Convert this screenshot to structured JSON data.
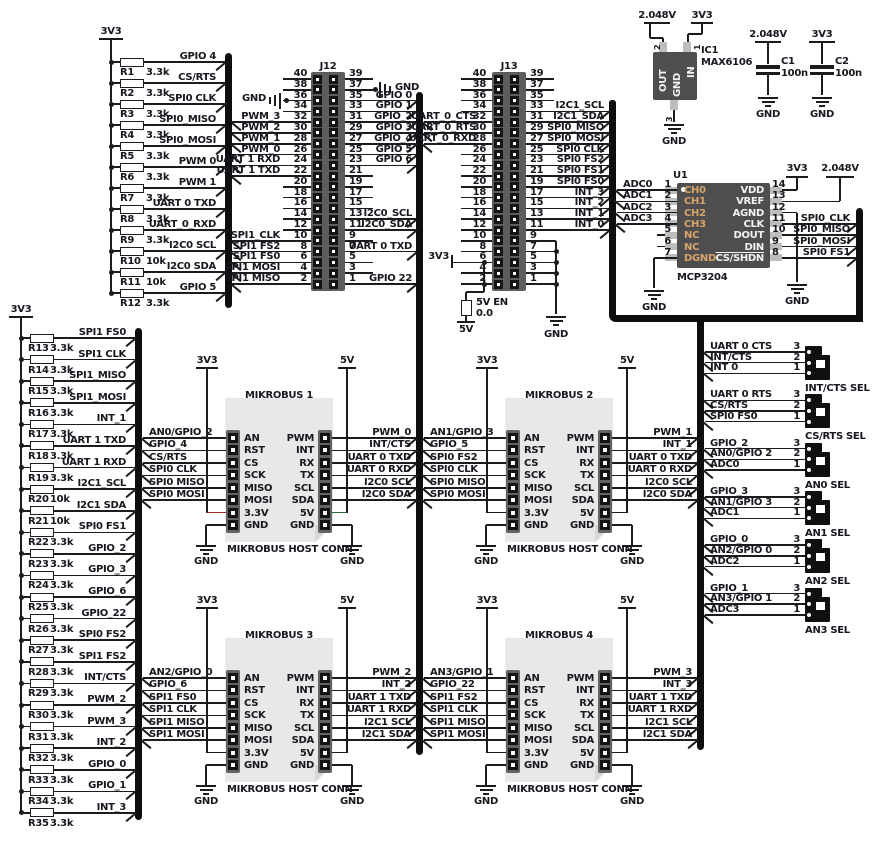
{
  "colors": {
    "wire": "#1c1c1e",
    "bus": "#0e0e10",
    "text": "#17171f",
    "chip_body": "#4e4e4e",
    "header_body": "#5d5d5d",
    "strip_body": "#636363",
    "pad": "#bdbdbd",
    "pin_dark": "#141414",
    "tan": "#d6a36a",
    "white": "#f2f2f2",
    "red": "#9b2f28",
    "green": "#2f6b33",
    "block_bg": "#e8e8e8",
    "fold": "#d8d8d8",
    "selector_body": "#101010"
  },
  "banks": {
    "top": {
      "rail": "3V3",
      "rows": [
        {
          "ref": "R1",
          "val": "3.3k",
          "sig": "GPIO 4"
        },
        {
          "ref": "R2",
          "val": "3.3k",
          "sig": "CS/RTS"
        },
        {
          "ref": "R3",
          "val": "3.3k",
          "sig": "SPI0 CLK"
        },
        {
          "ref": "R4",
          "val": "3.3k",
          "sig": "SPI0_MISO"
        },
        {
          "ref": "R5",
          "val": "3.3k",
          "sig": "SPI0_MOSI"
        },
        {
          "ref": "R6",
          "val": "3.3k",
          "sig": "PWM 0"
        },
        {
          "ref": "R7",
          "val": "3.3k",
          "sig": "PWM 1"
        },
        {
          "ref": "R8",
          "val": "3.3k",
          "sig": "UART 0 TXD"
        },
        {
          "ref": "R9",
          "val": "3.3k",
          "sig": "UART_0_RXD"
        },
        {
          "ref": "R10",
          "val": "10k",
          "sig": "I2C0 SCL"
        },
        {
          "ref": "R11",
          "val": "10k",
          "sig": "I2C0 SDA"
        },
        {
          "ref": "R12",
          "val": "3.3k",
          "sig": "GPIO 5"
        }
      ]
    },
    "left": {
      "rail": "3V3",
      "rows": [
        {
          "ref": "R13",
          "val": "3.3k",
          "sig": "SPI1 FS0"
        },
        {
          "ref": "R14",
          "val": "3.3k",
          "sig": "SPI1 CLK"
        },
        {
          "ref": "R15",
          "val": "3.3k",
          "sig": "SPI1_MISO"
        },
        {
          "ref": "R16",
          "val": "3.3k",
          "sig": "SPI1_MOSI"
        },
        {
          "ref": "R17",
          "val": "3.3k",
          "sig": "INT_1"
        },
        {
          "ref": "R18",
          "val": "3.3k",
          "sig": "UART 1 TXD"
        },
        {
          "ref": "R19",
          "val": "3.3k",
          "sig": "UART 1 RXD"
        },
        {
          "ref": "R20",
          "val": "10k",
          "sig": "I2C1_SCL"
        },
        {
          "ref": "R21",
          "val": "10k",
          "sig": "I2C1 SDA"
        },
        {
          "ref": "R22",
          "val": "3.3k",
          "sig": "SPI0 FS1"
        },
        {
          "ref": "R23",
          "val": "3.3k",
          "sig": "GPIO_2"
        },
        {
          "ref": "R24",
          "val": "3.3k",
          "sig": "GPIO_3"
        },
        {
          "ref": "R25",
          "val": "3.3k",
          "sig": "GPIO_6"
        },
        {
          "ref": "R26",
          "val": "3.3k",
          "sig": "GPIO_22"
        },
        {
          "ref": "R27",
          "val": "3.3k",
          "sig": "SPI0 FS2"
        },
        {
          "ref": "R28",
          "val": "3.3k",
          "sig": "SPI1 FS2"
        },
        {
          "ref": "R29",
          "val": "3.3k",
          "sig": "INT/CTS"
        },
        {
          "ref": "R30",
          "val": "3.3k",
          "sig": "PWM_2"
        },
        {
          "ref": "R31",
          "val": "3.3k",
          "sig": "PWM_3"
        },
        {
          "ref": "R32",
          "val": "3.3k",
          "sig": "INT_2"
        },
        {
          "ref": "R33",
          "val": "3.3k",
          "sig": "GPIO_0"
        },
        {
          "ref": "R34",
          "val": "3.3k",
          "sig": "GPIO_1"
        },
        {
          "ref": "R35",
          "val": "3.3k",
          "sig": "INT_3"
        }
      ]
    }
  },
  "headers": {
    "j12": {
      "title": "J12",
      "gnd_left": "GND",
      "gnd_right": "GND",
      "rows": [
        {
          "lp": "40",
          "rp": "39",
          "ll": "",
          "rl": ""
        },
        {
          "lp": "38",
          "rp": "37",
          "ll": "",
          "rl": ""
        },
        {
          "lp": "36",
          "rp": "35",
          "ll": "",
          "rl": "GPIO 0"
        },
        {
          "lp": "34",
          "rp": "33",
          "ll": "",
          "rl": "GPIO 1"
        },
        {
          "lp": "32",
          "rp": "31",
          "ll": "PWM_3",
          "rl": "GPIO_2"
        },
        {
          "lp": "30",
          "rp": "29",
          "ll": "PWM_2",
          "rl": "GPIO 3"
        },
        {
          "lp": "28",
          "rp": "27",
          "ll": "PWM_1",
          "rl": "GPIO_4"
        },
        {
          "lp": "26",
          "rp": "25",
          "ll": "PWM_0",
          "rl": "GPIO 5"
        },
        {
          "lp": "24",
          "rp": "23",
          "ll": "UART 1 RXD",
          "rl": "GPIO 6"
        },
        {
          "lp": "22",
          "rp": "21",
          "ll": "UART 1 TXD",
          "rl": ""
        },
        {
          "lp": "20",
          "rp": "19",
          "ll": "",
          "rl": ""
        },
        {
          "lp": "18",
          "rp": "17",
          "ll": "",
          "rl": ""
        },
        {
          "lp": "16",
          "rp": "15",
          "ll": "",
          "rl": ""
        },
        {
          "lp": "14",
          "rp": "13",
          "ll": "",
          "rl": "I2C0_SCL"
        },
        {
          "lp": "12",
          "rp": "11",
          "ll": "",
          "rl": "I2C0_SDA"
        },
        {
          "lp": "10",
          "rp": "9",
          "ll": "SPI1_CLK",
          "rl": ""
        },
        {
          "lp": "8",
          "rp": "7",
          "ll": "SPI1 FS2",
          "rl": "UART 0 TXD"
        },
        {
          "lp": "6",
          "rp": "5",
          "ll": "SPI1 FS0",
          "rl": ""
        },
        {
          "lp": "4",
          "rp": "3",
          "ll": "SPI1 MOSI",
          "rl": ""
        },
        {
          "lp": "2",
          "rp": "1",
          "ll": "SPI1 MISO",
          "rl": "GPIO 22"
        }
      ]
    },
    "j13": {
      "title": "J13",
      "rows": [
        {
          "lp": "40",
          "rp": "39",
          "ll": "",
          "rl": ""
        },
        {
          "lp": "38",
          "rp": "37",
          "ll": "",
          "rl": ""
        },
        {
          "lp": "36",
          "rp": "35",
          "ll": "",
          "rl": ""
        },
        {
          "lp": "34",
          "rp": "33",
          "ll": "",
          "rl": "I2C1_SCL"
        },
        {
          "lp": "32",
          "rp": "31",
          "ll": "UART_0_CTS",
          "rl": "I2C1_SDA"
        },
        {
          "lp": "30",
          "rp": "29",
          "ll": "UART_0_RTS",
          "rl": "SPI0_MISO"
        },
        {
          "lp": "28",
          "rp": "27",
          "ll": "UART_0_RXD",
          "rl": "SPI0_MOSI"
        },
        {
          "lp": "26",
          "rp": "25",
          "ll": "",
          "rl": "SPI0 CLK"
        },
        {
          "lp": "24",
          "rp": "23",
          "ll": "",
          "rl": "SPI0 FS2"
        },
        {
          "lp": "22",
          "rp": "21",
          "ll": "",
          "rl": "SPI0 FS1"
        },
        {
          "lp": "20",
          "rp": "19",
          "ll": "",
          "rl": "SPI0 FS0"
        },
        {
          "lp": "18",
          "rp": "17",
          "ll": "",
          "rl": "INT_3"
        },
        {
          "lp": "16",
          "rp": "15",
          "ll": "",
          "rl": "INT_2"
        },
        {
          "lp": "14",
          "rp": "13",
          "ll": "",
          "rl": "INT_1"
        },
        {
          "lp": "12",
          "rp": "11",
          "ll": "",
          "rl": "INT_0"
        },
        {
          "lp": "10",
          "rp": "9",
          "ll": "",
          "rl": ""
        },
        {
          "lp": "8",
          "rp": "7",
          "ll": "",
          "rl": ""
        },
        {
          "lp": "6",
          "rp": "5",
          "ll": "",
          "rl": ""
        },
        {
          "lp": "4",
          "rp": "3",
          "ll": "",
          "rl": ""
        },
        {
          "lp": "2",
          "rp": "1",
          "ll": "",
          "rl": ""
        }
      ],
      "bottom": {
        "v33": "3V3",
        "en": "5V EN",
        "en_val": "0.0",
        "v5": "5V",
        "gnd": "GND"
      }
    }
  },
  "vref": {
    "ref": "IC1",
    "part": "MAX6106",
    "out": "OUT",
    "in": "IN",
    "gnd": "GND",
    "out_net": "2.048V",
    "in_net": "3V3",
    "gnd_net": "GND",
    "pin_out": "2",
    "pin_in": "1",
    "pin_gnd": "3"
  },
  "caps": [
    {
      "ref": "C1",
      "val": "100n",
      "net": "2.048V",
      "gnd": "GND"
    },
    {
      "ref": "C2",
      "val": "100n",
      "net": "3V3",
      "gnd": "GND"
    }
  ],
  "adc": {
    "ref": "U1",
    "part": "MCP3204",
    "gnd": "GND",
    "left": [
      {
        "n": "1",
        "name": "CH0",
        "net": "ADC0"
      },
      {
        "n": "2",
        "name": "CH1",
        "net": "ADC1"
      },
      {
        "n": "3",
        "name": "CH2",
        "net": "ADC2"
      },
      {
        "n": "4",
        "name": "CH3",
        "net": "ADC3"
      },
      {
        "n": "5",
        "name": "NC",
        "net": ""
      },
      {
        "n": "6",
        "name": "NC",
        "net": ""
      },
      {
        "n": "7",
        "name": "DGND",
        "net": "GND"
      }
    ],
    "right": [
      {
        "n": "14",
        "name": "VDD",
        "net": "3V3"
      },
      {
        "n": "13",
        "name": "VREF",
        "net": "2.048V"
      },
      {
        "n": "12",
        "name": "AGND",
        "net": "GND"
      },
      {
        "n": "11",
        "name": "CLK",
        "net": "SPI0_CLK"
      },
      {
        "n": "10",
        "name": "DOUT",
        "net": "SPI0_MISO"
      },
      {
        "n": "9",
        "name": "DIN",
        "net": "SPI0_MOSI"
      },
      {
        "n": "8",
        "name": "CS/SHDN",
        "net": "SPI0 FS1"
      }
    ]
  },
  "mikrobus": {
    "caption": "MIKROBUS HOST CONN",
    "v33": "3V3",
    "v5": "5V",
    "gnd": "GND",
    "left_pins": [
      "AN",
      "RST",
      "CS",
      "SCK",
      "MISO",
      "MOSI",
      "3.3V",
      "GND"
    ],
    "right_pins": [
      "PWM",
      "INT",
      "RX",
      "TX",
      "SCL",
      "SDA",
      "5V",
      "GND"
    ],
    "blocks": [
      {
        "title": "MIKROBUS 1",
        "left": [
          "AN0/GPIO_2",
          "GPIO_4",
          "CS/RTS",
          "SPI0 CLK",
          "SPI0 MISO",
          "SPI0 MOSI"
        ],
        "right": [
          "PWM_0",
          "INT/CTS",
          "UART 0 TXD",
          "UART 0 RXD",
          "I2C0 SCL",
          "I2C0 SDA"
        ]
      },
      {
        "title": "MIKROBUS 2",
        "left": [
          "AN1/GPIO_3",
          "GPIO_5",
          "SPI0 FS2",
          "SPI0 CLK",
          "SPI0 MISO",
          "SPI0 MOSI"
        ],
        "right": [
          "PWM_1",
          "INT_1",
          "UART 0 TXD",
          "UART 0 RXD",
          "I2C0 SCL",
          "I2C0 SDA"
        ]
      },
      {
        "title": "MIKROBUS 3",
        "left": [
          "AN2/GPIO_0",
          "GPIO_6",
          "SPI1 FS0",
          "SPI1 CLK",
          "SPI1 MISO",
          "SPI1 MOSI"
        ],
        "right": [
          "PWM_2",
          "INT_2",
          "UART 1 TXD",
          "UART 1 RXD",
          "I2C1 SCL",
          "I2C1 SDA"
        ]
      },
      {
        "title": "MIKROBUS 4",
        "left": [
          "AN3/GPIO_1",
          "GPIO_22",
          "SPI1 FS2",
          "SPI1 CLK",
          "SPI1 MISO",
          "SPI1 MOSI"
        ],
        "right": [
          "PWM_3",
          "INT_3",
          "UART 1 TXD",
          "UART 1 RXD",
          "I2C1 SCL",
          "I2C1 SDA"
        ]
      }
    ]
  },
  "selectors": {
    "pins": [
      "3",
      "2",
      "1"
    ],
    "groups": [
      {
        "label": "INT/CTS SEL",
        "nets": [
          "UART 0 CTS",
          "INT/CTS",
          "INT 0"
        ]
      },
      {
        "label": "CS/RTS SEL",
        "nets": [
          "UART 0 RTS",
          "CS/RTS",
          "SPI0 FS0"
        ]
      },
      {
        "label": "AN0 SEL",
        "nets": [
          "GPIO_2",
          "AN0/GPIO 2",
          "ADC0"
        ]
      },
      {
        "label": "AN1 SEL",
        "nets": [
          "GPIO_3",
          "AN1/GPIO 3",
          "ADC1"
        ]
      },
      {
        "label": "AN2 SEL",
        "nets": [
          "GPIO_0",
          "AN2/GPIO 0",
          "ADC2"
        ]
      },
      {
        "label": "AN3 SEL",
        "nets": [
          "GPIO_1",
          "AN3/GPIO 1",
          "ADC3"
        ]
      }
    ]
  }
}
